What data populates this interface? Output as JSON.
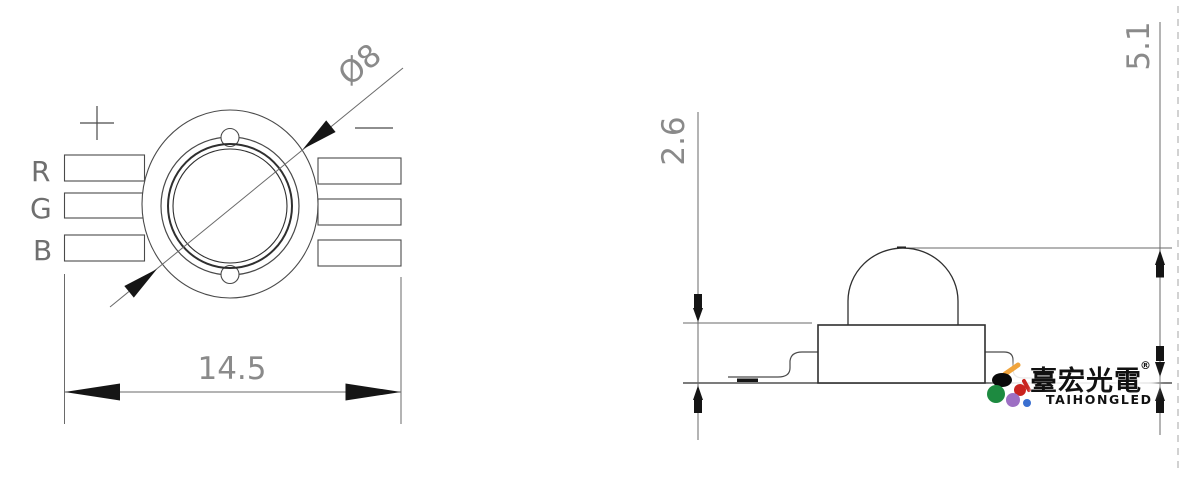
{
  "colors": {
    "background": "#ffffff",
    "line": "#4a4a4a",
    "dark_line": "#2f2f2f",
    "dim_line": "#6a6a6a",
    "arrow": "#151515",
    "dim_text": "#8a8a8a",
    "label_text": "#6f6f6f",
    "logo_text": "#111111",
    "logo_orange": "#f0a43c",
    "logo_green": "#1d8a40",
    "logo_red": "#c9231f",
    "logo_purple": "#9d6fc3",
    "logo_blue": "#3a6fd0",
    "logo_black": "#0a0a0a",
    "page_edge": "#b4b4b4"
  },
  "top_view": {
    "pin_labels": [
      "R",
      "G",
      "B"
    ],
    "polarity_positive": "+",
    "polarity_negative": "−",
    "dim_diameter": "Ø8",
    "dim_overall_width": "14.5"
  },
  "side_view": {
    "dim_body_height": "2.6",
    "dim_total_height": "5.1"
  },
  "logo": {
    "cjk_name": "臺宏光電",
    "registered_mark": "®",
    "latin_name": "TAIHONGLED"
  }
}
